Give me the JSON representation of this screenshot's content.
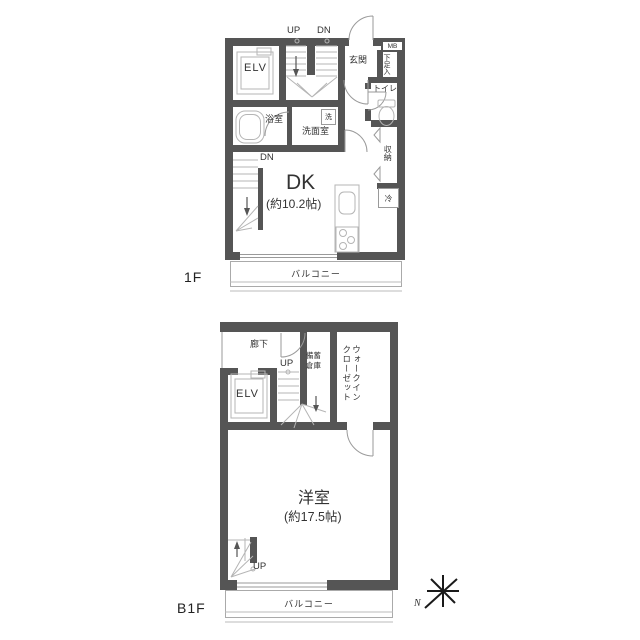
{
  "colors": {
    "wall": "#555555",
    "linework": "#b5b5b5",
    "door": "#999999",
    "text": "#333333"
  },
  "f1": {
    "floor_label": "1F",
    "up": "UP",
    "dn": "DN",
    "elevator": "ELV",
    "entrance": "玄関",
    "meter_box": "MB",
    "shoe_box": "下足入",
    "toilet": "トイレ",
    "bath": "浴室",
    "washroom": "洗面室",
    "washer": "洗",
    "dn_lower": "DN",
    "dk": "DK",
    "dk_size": "(約10.2帖)",
    "closet": "収納",
    "fridge": "冷",
    "balcony": "バルコニー"
  },
  "b1": {
    "floor_label": "B1F",
    "corridor": "廊下",
    "up": "UP",
    "stock_line1": "備蓄",
    "stock_line2": "倉庫",
    "wic_line1": "ウォークイン",
    "wic_line2": "クローゼット",
    "elevator": "ELV",
    "room": "洋室",
    "room_size": "(約17.5帖)",
    "up_lower": "UP",
    "balcony": "バルコニー"
  },
  "compass": {
    "north": "N"
  }
}
